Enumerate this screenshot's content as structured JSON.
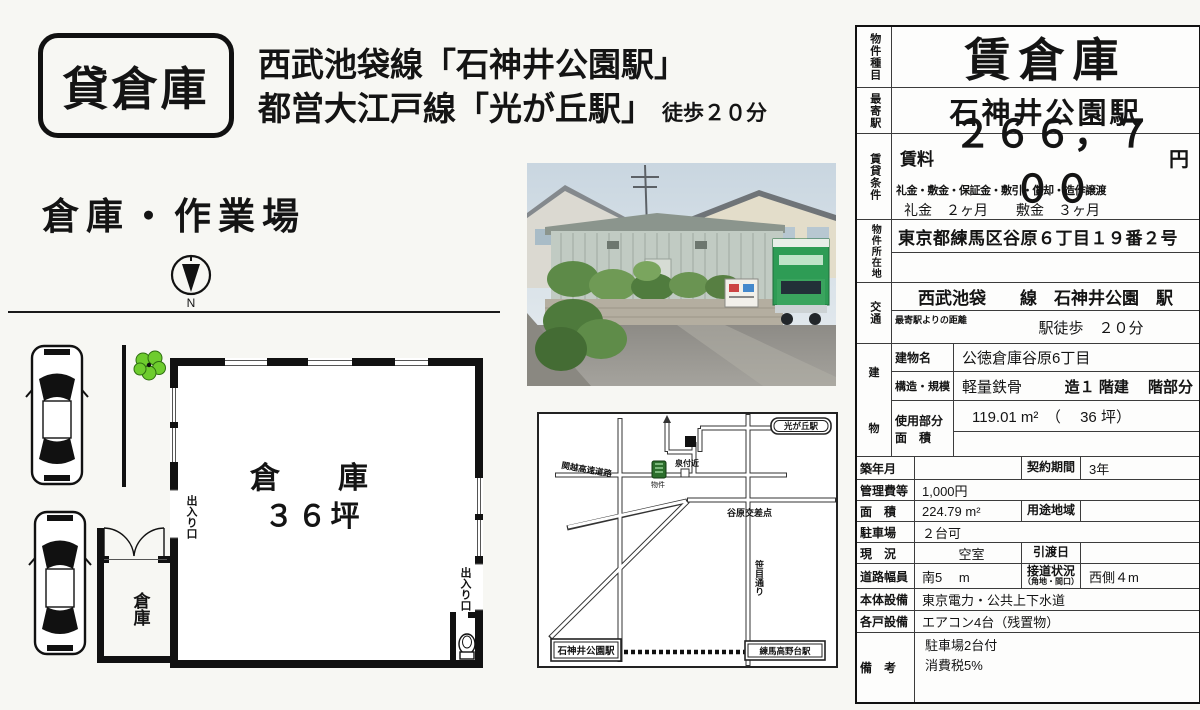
{
  "badge": {
    "label": "貸倉庫"
  },
  "header": {
    "line1": "西武池袋線「石神井公園駅」",
    "line2": "都営大江戸線「光が丘駅」",
    "walk_note": "徒歩２０分"
  },
  "subtitle": "倉庫・作業場",
  "compass": {
    "label": "N"
  },
  "floorplan": {
    "main_room_name": "倉　庫",
    "main_room_size": "３６坪",
    "annex_name": "倉庫",
    "entrance_left": "出入り口",
    "entrance_right": "出入り口"
  },
  "map": {
    "station_top_right": "光が丘駅",
    "expressway_label": "関越高速道路",
    "landmark_label": "泉付近",
    "property_marker_label": "物件",
    "intersection_label": "谷原交差点",
    "street_label": "笹目通り",
    "station_left": "石神井公園駅",
    "station_right": "練馬高野台駅"
  },
  "table": {
    "property_type": {
      "label": "物件種目",
      "value": "賃倉庫"
    },
    "nearest_station": {
      "label": "最寄駅",
      "value": "石神井公園駅"
    },
    "rental_terms": {
      "label": "賃貸条件",
      "rent_label": "賃料",
      "rent_value": "２６６，７００",
      "rent_unit": "円",
      "conditions_header": "礼金・敷金・保証金・敷引・償却・造作譲渡",
      "conditions_value": "礼金　２ヶ月　　敷金　３ヶ月"
    },
    "location": {
      "label": "物件所在地",
      "value": "東京都練馬区谷原６丁目１９番２号"
    },
    "access": {
      "label": "交通",
      "line": "西武池袋　　線　石神井公園　駅",
      "distance_label": "最寄駅よりの距離",
      "distance_value": "駅徒歩　２０分"
    },
    "building": {
      "label_top": "建",
      "label_bottom": "物",
      "name_label": "建物名",
      "name_value": "公徳倉庫谷原6丁目",
      "structure_label": "構造・規模",
      "structure_value": "軽量鉄骨",
      "structure_value2": "造１ 階建　 階部分",
      "area_label1": "使用部分",
      "area_label2": "面　積",
      "area_value": "119.01 m²　（　 36 坪）"
    },
    "rows": {
      "built": {
        "label": "築年月",
        "value": ""
      },
      "contract": {
        "label": "契約期間",
        "value": "3年"
      },
      "fee": {
        "label": "管理費等",
        "value": "1,000円"
      },
      "land_area": {
        "label": "面　積",
        "value": "224.79 m²"
      },
      "zoning": {
        "label": "用途地域",
        "value": ""
      },
      "parking": {
        "label": "駐車場",
        "value": "２台可"
      },
      "status": {
        "label": "現　況",
        "value": "空室"
      },
      "handover": {
        "label": "引渡日",
        "value": ""
      },
      "road_width": {
        "label": "道路幅員",
        "value": "南5　 m"
      },
      "frontage": {
        "label1": "接道状況",
        "label2": "（角地・間口）",
        "value": "西側４m"
      },
      "utilities": {
        "label": "本体設備",
        "value": "東京電力・公共上下水道"
      },
      "unit_equipment": {
        "label": "各戸設備",
        "value": "エアコン4台（残置物）"
      },
      "notes": {
        "label": "備　考",
        "value1": "駐車場2台付",
        "value2": "消費税5%"
      }
    }
  }
}
